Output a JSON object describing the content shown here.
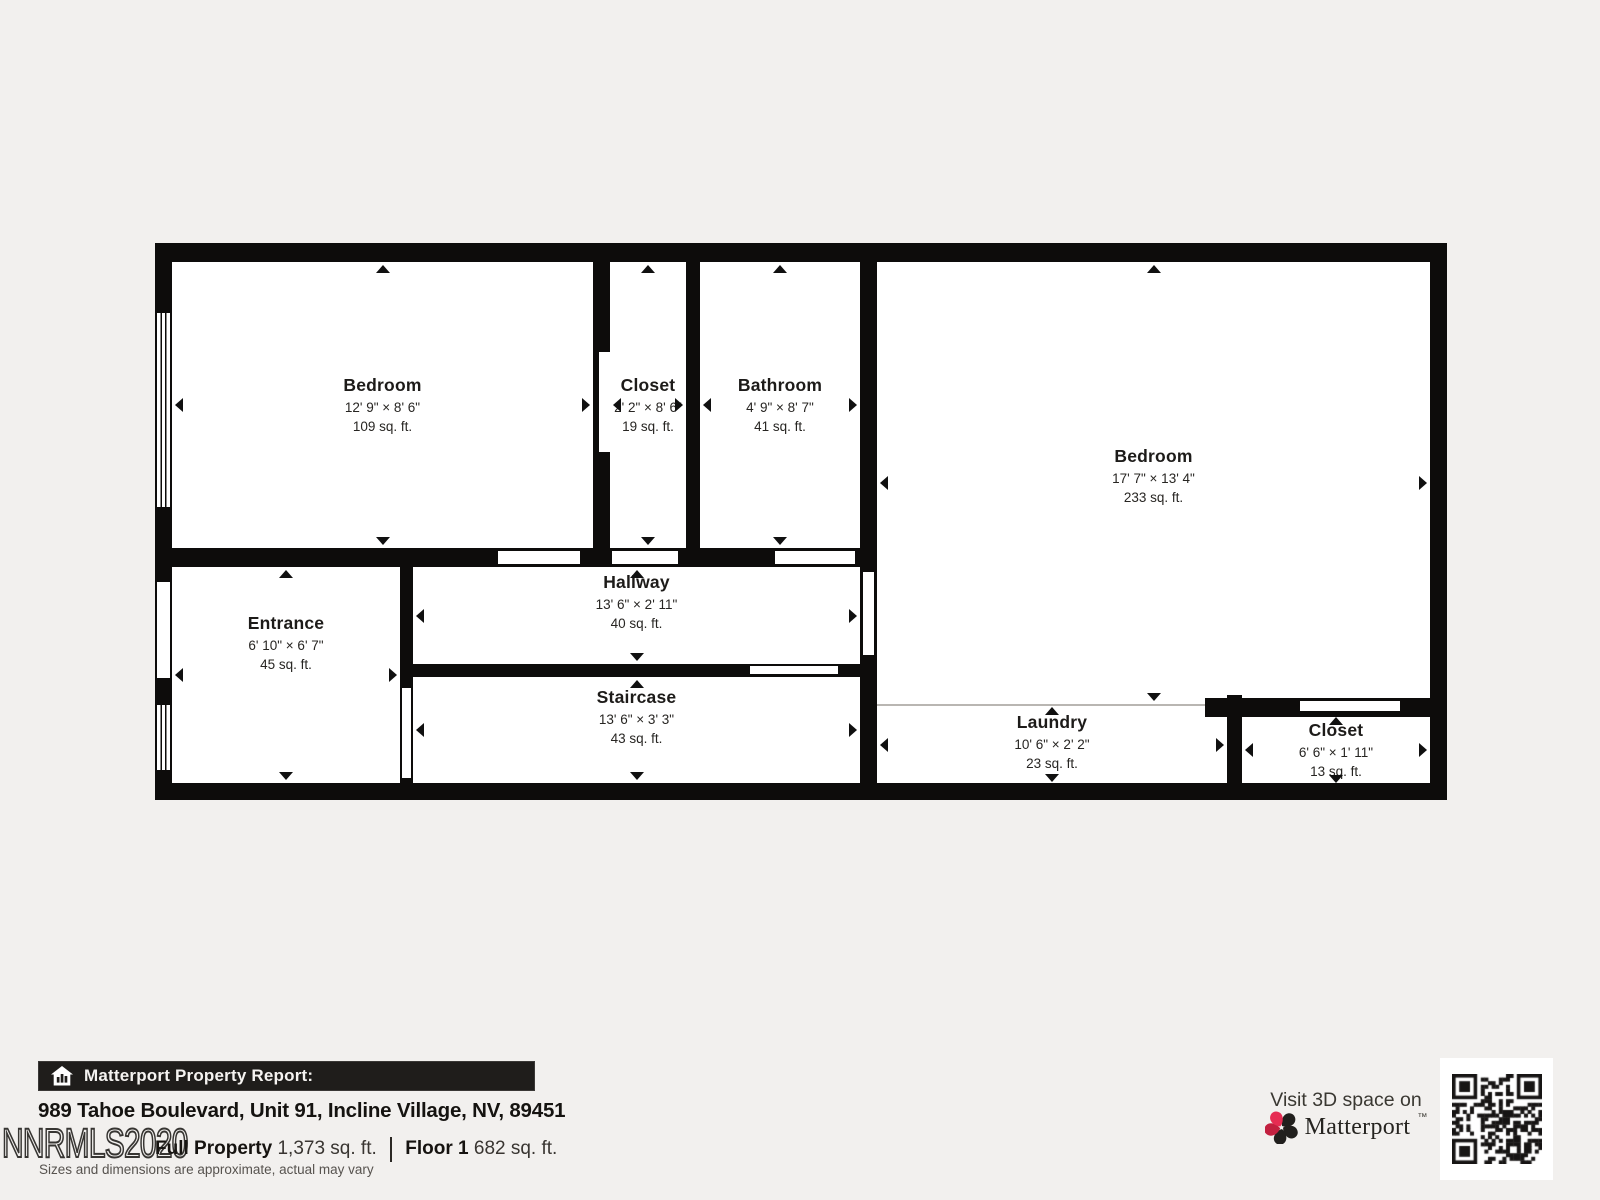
{
  "floor_plan": {
    "rooms": [
      {
        "id": "bedroom-left",
        "name": "Bedroom",
        "dims": "12' 9\" × 8' 6\"",
        "area": "109 sq. ft."
      },
      {
        "id": "closet-top",
        "name": "Closet",
        "dims": "2' 2\" × 8' 6\"",
        "area": "19 sq. ft."
      },
      {
        "id": "bathroom",
        "name": "Bathroom",
        "dims": "4' 9\" × 8' 7\"",
        "area": "41 sq. ft."
      },
      {
        "id": "bedroom-right",
        "name": "Bedroom",
        "dims": "17' 7\" × 13' 4\"",
        "area": "233 sq. ft."
      },
      {
        "id": "entrance",
        "name": "Entrance",
        "dims": "6' 10\" × 6' 7\"",
        "area": "45 sq. ft."
      },
      {
        "id": "hallway",
        "name": "Hallway",
        "dims": "13' 6\" × 2' 11\"",
        "area": "40 sq. ft."
      },
      {
        "id": "staircase",
        "name": "Staircase",
        "dims": "13' 6\" × 3' 3\"",
        "area": "43 sq. ft."
      },
      {
        "id": "laundry",
        "name": "Laundry",
        "dims": "10' 6\" × 2' 2\"",
        "area": "23 sq. ft."
      },
      {
        "id": "closet-bottom",
        "name": "Closet",
        "dims": "6' 6\" × 1' 11\"",
        "area": "13 sq. ft."
      }
    ]
  },
  "report": {
    "bar_title": "Matterport Property Report:",
    "address": "989 Tahoe Boulevard, Unit 91, Incline Village, NV, 89451",
    "full_property_label": "Full Property",
    "full_property_area": "1,373 sq. ft.",
    "floor_label": "Floor 1",
    "floor_area": "682 sq. ft.",
    "disclaimer": "Sizes and dimensions are approximate, actual may vary",
    "watermark": "NNRMLS2020",
    "space": " "
  },
  "cta": {
    "visit_text": "Visit 3D space on",
    "brand": "Matterport",
    "trademark": "™"
  },
  "icons": {
    "report_bar": "house-chart-icon",
    "brand": "matterport-pinwheel-icon",
    "qr": "qr-code",
    "measure_arrows": "measure-arrow-icons"
  },
  "colors": {
    "background": "#f2f0ee",
    "plan_floor": "#ffffff",
    "walls": "#0d0c0b",
    "report_bar_bg": "#1f1d1b",
    "brand_red": "#e62c52",
    "brand_dark_red": "#c2203f",
    "text_dark": "#1d1b19",
    "text_gray": "#57534f"
  }
}
